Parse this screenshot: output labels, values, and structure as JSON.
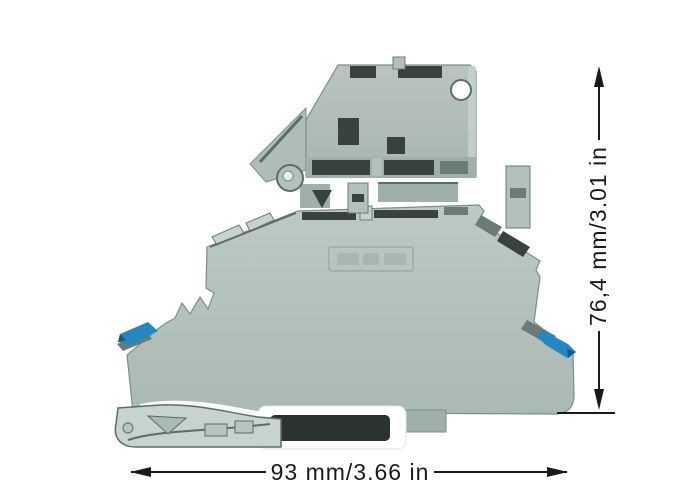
{
  "dimensions": {
    "height_label": "76,4 mm/3.01 in",
    "width_label": "93 mm/3.66 in"
  },
  "illustration": {
    "description": "side view of a two-level DIN-rail fuse terminal block with pivoting fuse holder",
    "parts": [
      "fuse-holder",
      "terminal-body",
      "release-lever-left",
      "release-lever-right",
      "mounting-foot",
      "din-rail"
    ]
  },
  "colors": {
    "background": "#ffffff",
    "body": "#b3c1bc",
    "body_light": "#c7d3ce",
    "body_mid": "#9fafaa",
    "body_dark": "#6b7b77",
    "outline": "#5e6c68",
    "slot_dark": "#39423f",
    "accent_blue": "#2487c1",
    "blue_dark": "#155a86",
    "rail_band": "#2b332f",
    "dimension": "#1a1a1a"
  }
}
